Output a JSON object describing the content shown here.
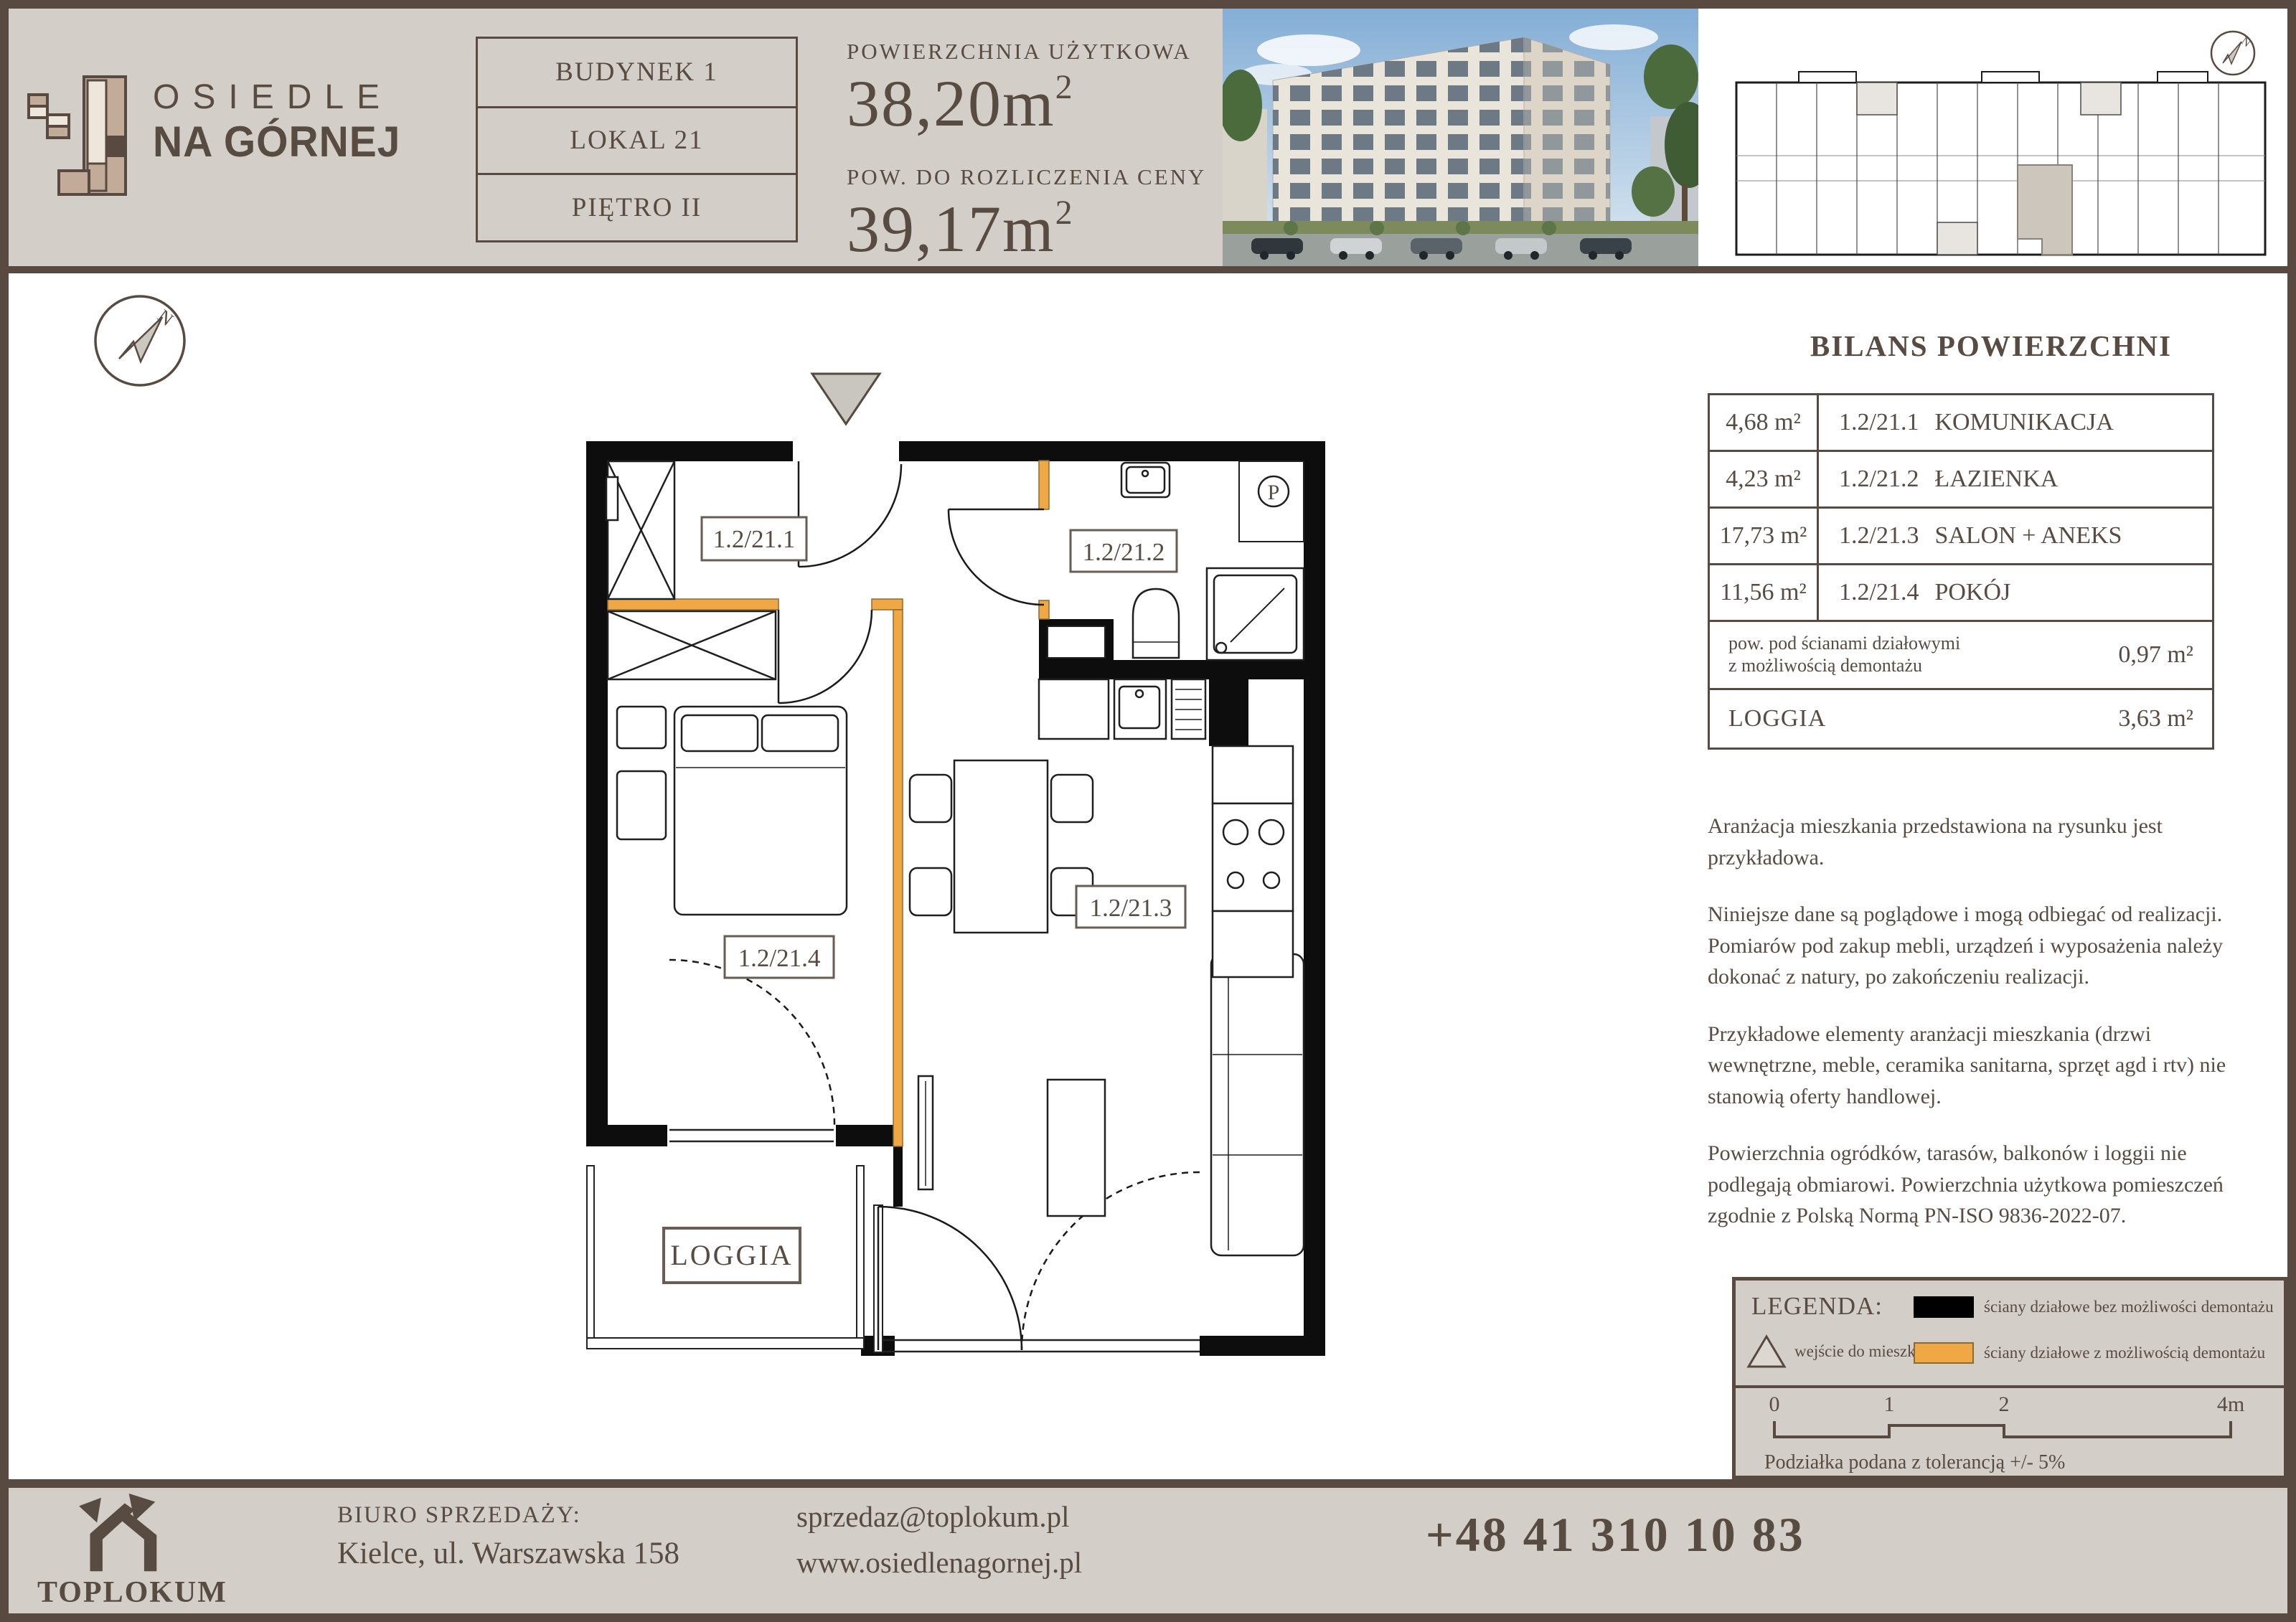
{
  "logo": {
    "line1": "OSIEDLE",
    "line2": "NA GÓRNEJ"
  },
  "unit_info": {
    "building": "BUDYNEK 1",
    "unit": "LOKAL 21",
    "floor": "PIĘTRO II"
  },
  "areas": {
    "usable_label": "POWIERZCHNIA UŻYTKOWA",
    "usable_value": "38,20m",
    "billing_label": "POW. DO ROZLICZENIA CENY",
    "billing_value": "39,17m",
    "sup": "2"
  },
  "compass": {
    "north": "N"
  },
  "plan": {
    "labels": {
      "hall": "1.2/21.1",
      "bath": "1.2/21.2",
      "living": "1.2/21.3",
      "bedroom": "1.2/21.4",
      "loggia": "LOGGIA",
      "washer": "P"
    }
  },
  "balance": {
    "title": "BILANS POWIERZCHNI",
    "rows": [
      {
        "area": "4,68 m²",
        "code": "1.2/21.1",
        "name": "KOMUNIKACJA"
      },
      {
        "area": "4,23 m²",
        "code": "1.2/21.2",
        "name": "ŁAZIENKA"
      },
      {
        "area": "17,73 m²",
        "code": "1.2/21.3",
        "name": "SALON + ANEKS"
      },
      {
        "area": "11,56 m²",
        "code": "1.2/21.4",
        "name": "POKÓJ"
      }
    ],
    "partition_label_1": "pow. pod ścianami działowymi",
    "partition_label_2": "z możliwością demontażu",
    "partition_value": "0,97 m²",
    "loggia_label": "LOGGIA",
    "loggia_value": "3,63 m²"
  },
  "disclaimers": [
    "Aranżacja mieszkania przedstawiona na rysunku jest przykładowa.",
    "Niniejsze dane są poglądowe i mogą odbiegać od realizacji. Pomiarów pod zakup mebli, urządzeń i wyposażenia należy dokonać z natury, po zakończeniu realizacji.",
    "Przykładowe elementy aranżacji mieszkania (drzwi wewnętrzne, meble, ceramika sanitarna, sprzęt agd i rtv) nie stanowią oferty handlowej.",
    "Powierzchnia ogródków, tarasów, balkonów i loggii nie podlegają obmiarowi. Powierzchnia użytkowa pomieszczeń zgodnie z Polską Normą PN-ISO 9836-2022-07."
  ],
  "legend": {
    "title": "LEGENDA:",
    "entrance_label": "wejście do mieszkania",
    "fixed_label": "ściany działowe bez możliwości demontażu",
    "removable_label": "ściany działowe z możliwością demontażu",
    "ticks": [
      "0",
      "1",
      "2",
      "4m"
    ],
    "tolerance": "Podziałka podana z tolerancją +/- 5%"
  },
  "footer": {
    "brand": "TOPLOKUM",
    "office_label": "BIURO SPRZEDAŻY:",
    "address": "Kielce, ul. Warszawska 158",
    "email": "sprzedaz@toplokum.pl",
    "website": "www.osiedlenagornej.pl",
    "phone": "+48 41 310 10 83"
  },
  "colors": {
    "accent_orange": "#f0a844",
    "frame_brown": "#594a41",
    "beige": "#d3cfc8"
  }
}
